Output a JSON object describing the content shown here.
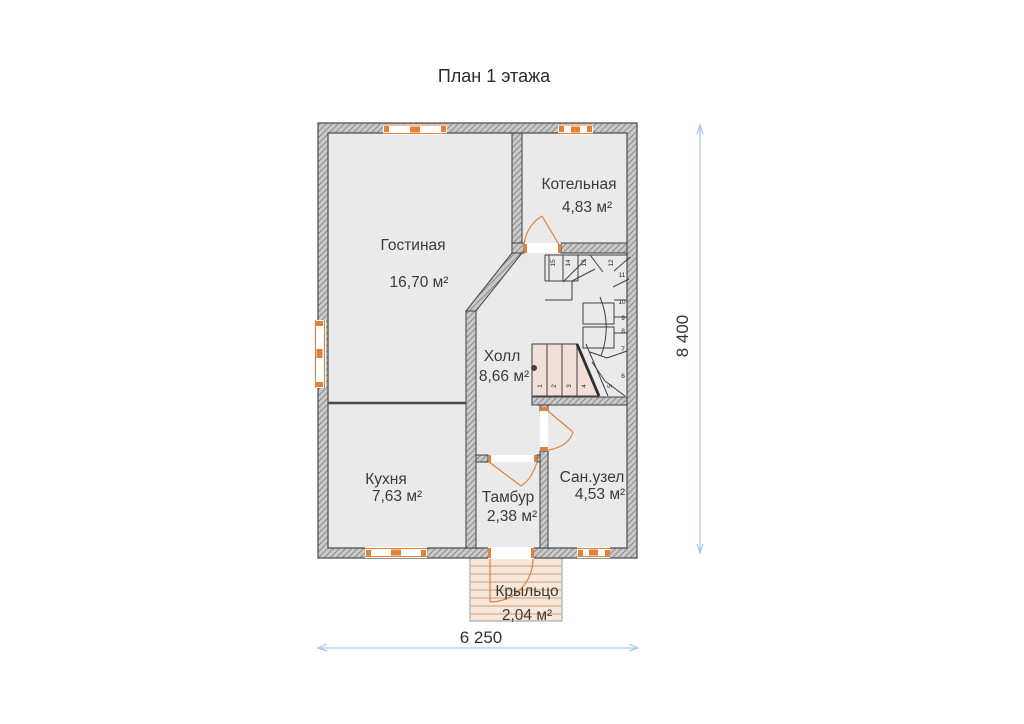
{
  "title": "План 1 этажа",
  "plan": {
    "rooms": [
      {
        "name": "Гостиная",
        "area": "16,70 м²"
      },
      {
        "name": "Котельная",
        "area": "4,83 м²"
      },
      {
        "name": "Холл",
        "area": "8,66 м²"
      },
      {
        "name": "Кухня",
        "area": "7,63 м²"
      },
      {
        "name": "Тамбур",
        "area": "2,38 м²"
      },
      {
        "name": "Сан.узел",
        "area": "4,53 м²"
      },
      {
        "name": "Крыльцо",
        "area": "2,04 м²"
      }
    ],
    "dimensions": {
      "width_label": "6 250",
      "height_label": "8 400"
    },
    "stairs": {
      "steps": [
        "1",
        "2",
        "3",
        "4",
        "5",
        "6",
        "7",
        "8",
        "9",
        "10",
        "11",
        "12",
        "13",
        "14",
        "15"
      ]
    },
    "colors": {
      "accent_orange": "#e0813c",
      "wall_fill": "#c9c9c9",
      "wall_hatch": "#8f8f8f",
      "wall_outline": "#4d4d4d",
      "room_fill": "#eaeaea",
      "stair_highlight": "#f2dfda",
      "porch_fill": "#f7e8da",
      "dimension_blue": "#a9c6e6",
      "text_color": "#333333"
    }
  }
}
